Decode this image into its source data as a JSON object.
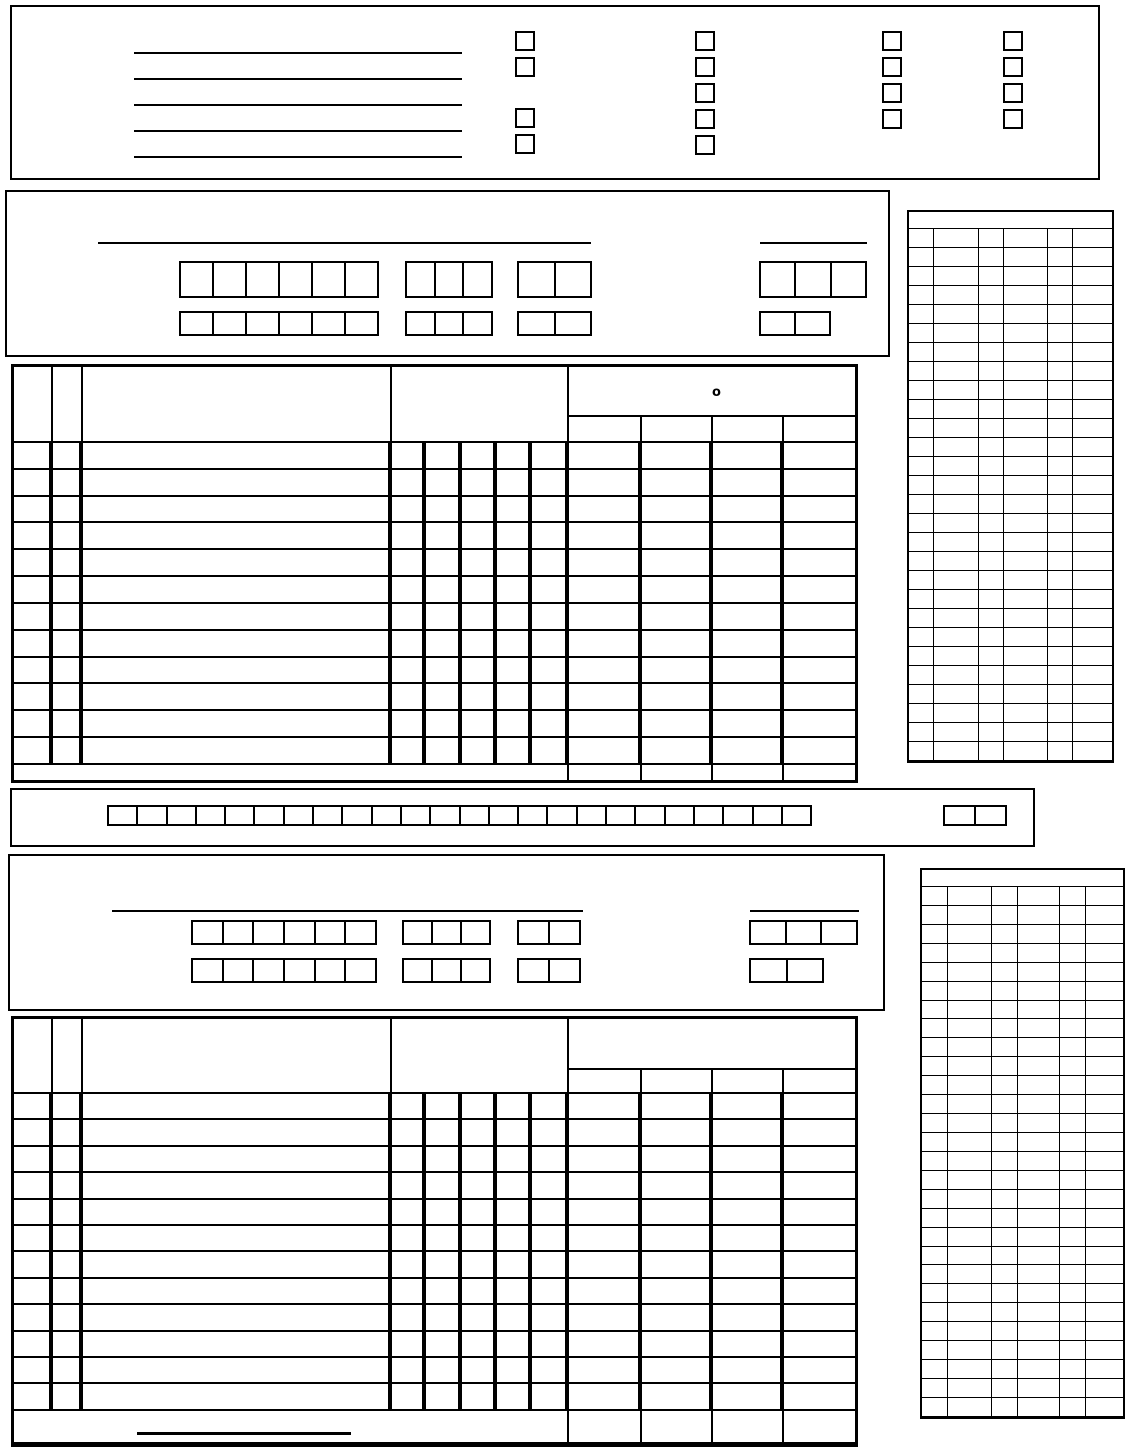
{
  "palette": {
    "ink": "#000000",
    "paper": "#ffffff"
  },
  "top_header": {
    "blank_line_count": 5,
    "checkbox_columns": [
      {
        "name": "group-1",
        "stacks": [
          2,
          2
        ]
      },
      {
        "name": "group-2",
        "stacks": [
          5
        ]
      },
      {
        "name": "group-3",
        "stacks": [
          4
        ]
      },
      {
        "name": "group-4",
        "stacks": [
          4
        ]
      }
    ]
  },
  "team_a": {
    "name_line": "",
    "ref_line": "",
    "row1": {
      "g1": 6,
      "g2": 3,
      "g3": 2,
      "right": 3
    },
    "row2": {
      "g1": 6,
      "g2": 3,
      "g3": 2,
      "right": 2
    }
  },
  "roster_a": {
    "data_rows": 12,
    "header_mark": "o"
  },
  "strip": {
    "cells": 24,
    "right_cells": 2
  },
  "team_b": {
    "name_line": "",
    "ref_line": "",
    "row1": {
      "g1": 6,
      "g2": 3,
      "g3": 2,
      "right": 3
    },
    "row2": {
      "g1": 6,
      "g2": 3,
      "g3": 2,
      "right": 2
    }
  },
  "roster_b": {
    "data_rows": 12,
    "footer_line": ""
  },
  "score_grid_a": {
    "header_rows": 1,
    "data_rows": 28,
    "columns": 6
  },
  "score_grid_b": {
    "header_rows": 1,
    "data_rows": 28,
    "columns": 6
  }
}
